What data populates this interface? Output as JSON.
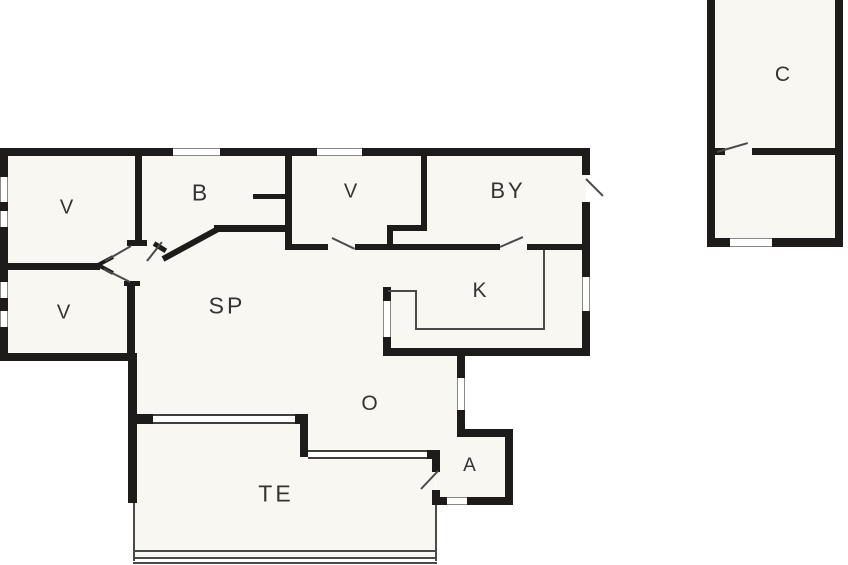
{
  "plan": {
    "title": "floor-plan",
    "colors": {
      "background": "#ffffff",
      "floor_fill": "#f8f7f1",
      "wall": "#1d1c1a",
      "thin_line": "#4a4a4a",
      "label_text": "#333330"
    },
    "rooms": [
      {
        "id": "v-upper-left",
        "label": "V"
      },
      {
        "id": "b",
        "label": "B"
      },
      {
        "id": "v-middle",
        "label": "V"
      },
      {
        "id": "by",
        "label": "BY"
      },
      {
        "id": "v-lower-left",
        "label": "V"
      },
      {
        "id": "sp",
        "label": "SP"
      },
      {
        "id": "k",
        "label": "K"
      },
      {
        "id": "o",
        "label": "O"
      },
      {
        "id": "a",
        "label": "A"
      },
      {
        "id": "te",
        "label": "TE"
      },
      {
        "id": "c",
        "label": "C"
      }
    ]
  }
}
